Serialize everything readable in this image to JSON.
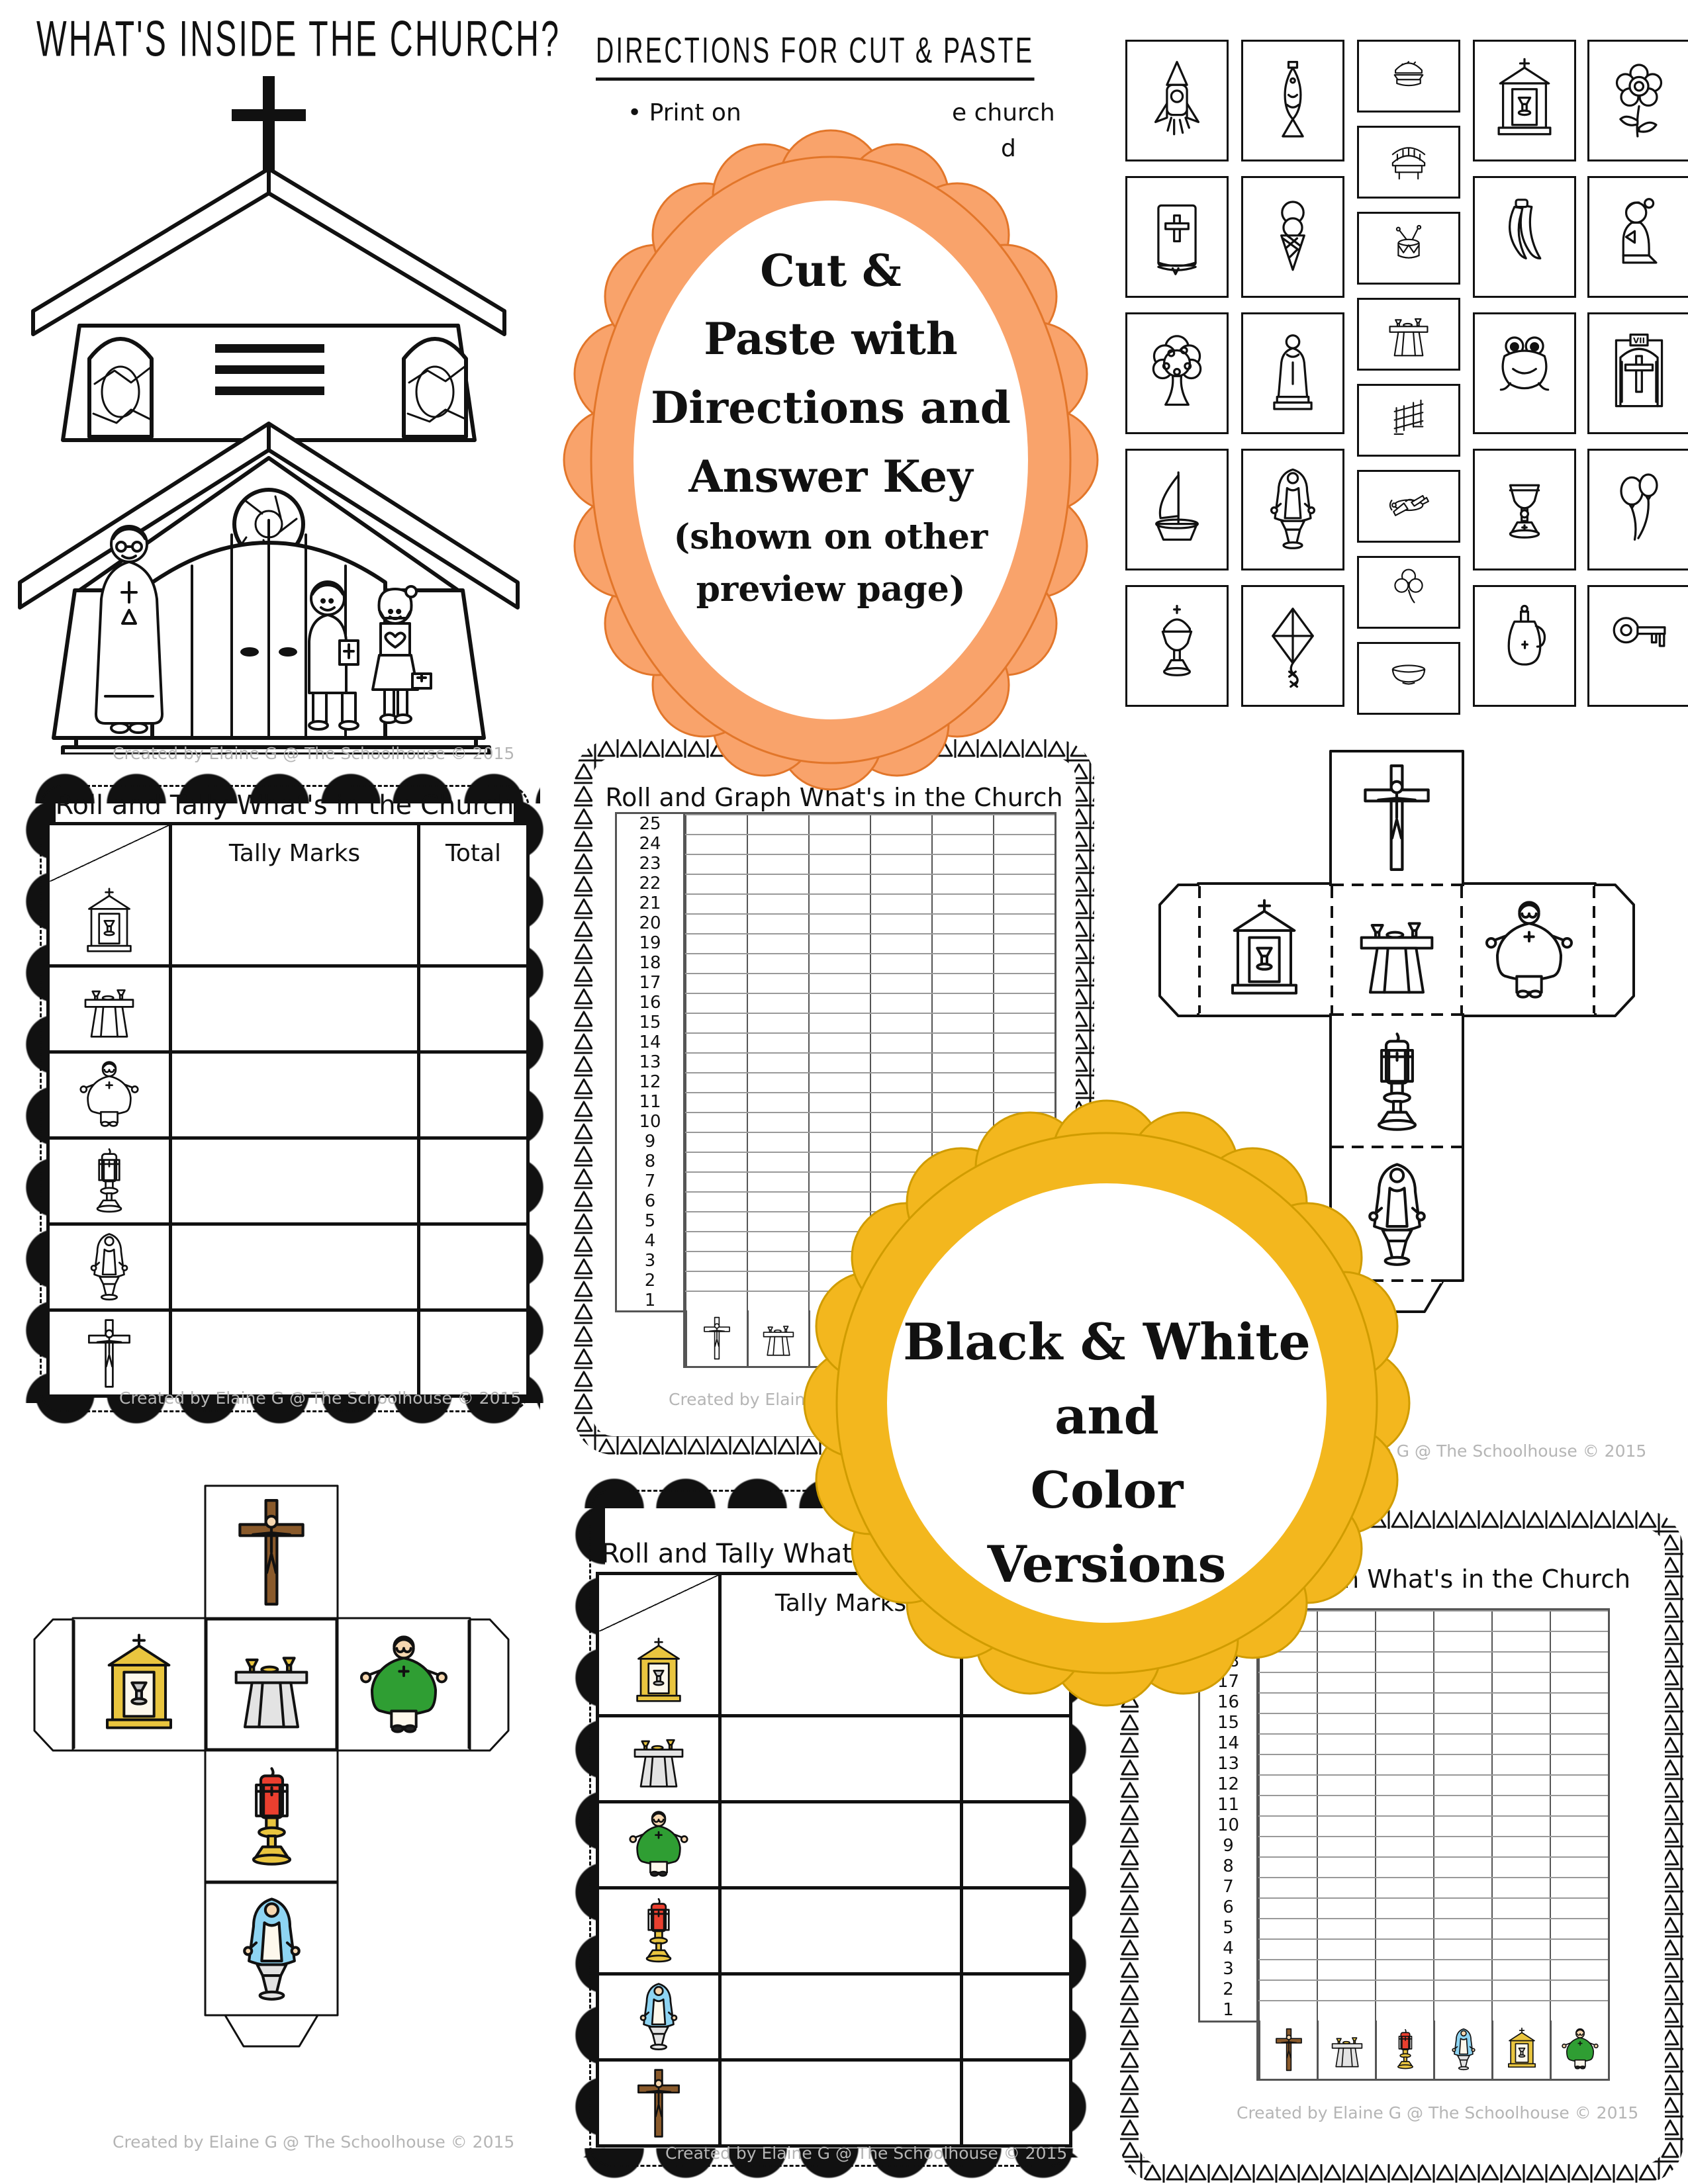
{
  "page": {
    "title": "WHAT'S INSIDE THE CHURCH?"
  },
  "shared": {
    "credit": "Created by Elaine G @ The Schoolhouse © 2015"
  },
  "directions": {
    "heading": "DIRECTIONS FOR CUT & PASTE",
    "bullet_left": "• Print on",
    "bullet_right": "e church",
    "bullet_cont": "d"
  },
  "badges": {
    "orange": {
      "fill": "#F9A36B",
      "rim": "#E2762A",
      "lines": [
        "Cut &",
        "Paste with",
        "Directions and",
        "Answer Key",
        "(shown on other",
        "preview page)"
      ]
    },
    "yellow": {
      "fill": "#F3B71E",
      "rim": "#D09C00",
      "lines": [
        "Black & White",
        "and",
        "Color",
        "Versions"
      ]
    }
  },
  "cards": {
    "station_label": "VII",
    "col1": [
      "rocket",
      "bible",
      "tree",
      "sailboat",
      "ciborium"
    ],
    "col2": [
      "fish",
      "ice-cream",
      "saint",
      "mary",
      "kite"
    ],
    "col3": [
      "hamburger",
      "bridge",
      "drum",
      "altar",
      "kneeler",
      "airplane",
      "shamrock",
      "bowl"
    ],
    "col4": [
      "tabernacle",
      "bananas",
      "frog",
      "chalice",
      "cruet"
    ],
    "col5": [
      "flower",
      "praying-girl",
      "station",
      "balloons",
      "key"
    ]
  },
  "tally": {
    "title": "Roll and Tally What's in the Church",
    "col_tally": "Tally Marks",
    "col_total": "Total",
    "rows": [
      "tabernacle",
      "altar",
      "priest",
      "candle",
      "mary",
      "crucifix"
    ]
  },
  "graph": {
    "title": "Roll and Graph What's in the Church",
    "numbers_bw": [
      "25",
      "24",
      "23",
      "22",
      "21",
      "20",
      "19",
      "18",
      "17",
      "16",
      "15",
      "14",
      "13",
      "12",
      "11",
      "10",
      "9",
      "8",
      "7",
      "6",
      "5",
      "4",
      "3",
      "2",
      "1"
    ],
    "numbers_color": [
      "20",
      "19",
      "18",
      "17",
      "16",
      "15",
      "14",
      "13",
      "12",
      "11",
      "10",
      "9",
      "8",
      "7",
      "6",
      "5",
      "4",
      "3",
      "2",
      "1"
    ],
    "icons": [
      "crucifix",
      "altar",
      "candle",
      "mary",
      "tabernacle",
      "priest"
    ]
  },
  "colors": {
    "ink": "#111111",
    "credit_gray": "#B5B5B5",
    "accent_orange": "#F9A36B",
    "accent_yellow": "#F3B71E"
  }
}
